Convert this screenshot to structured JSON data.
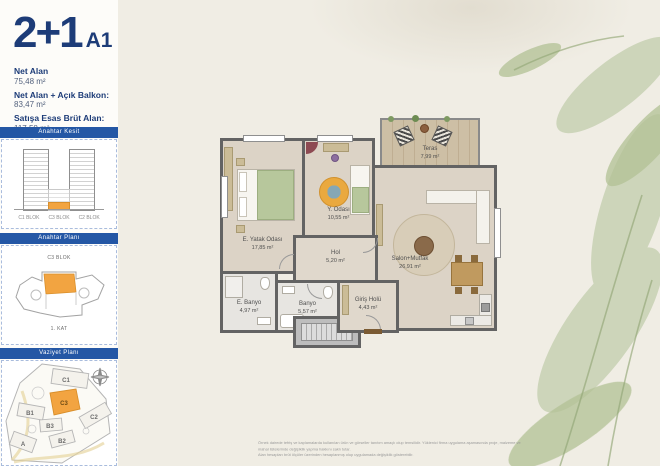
{
  "header": {
    "unit_type": "2+1",
    "variant": "A1"
  },
  "stats": {
    "items": [
      {
        "label": "Net Alan",
        "value": "75,48 m²"
      },
      {
        "label": "Net Alan + Açık Balkon:",
        "value": "83,47 m²"
      },
      {
        "label": "Satışa Esas Brüt Alan:",
        "value": "117,58 m²"
      }
    ]
  },
  "sidebar": {
    "key_section": {
      "title": "Anahtar Kesit",
      "block_labels": [
        "C1 BLOK",
        "C3 BLOK",
        "C2 BLOK"
      ]
    },
    "key_plan": {
      "title": "Anahtar Planı",
      "block_label": "C3 BLOK",
      "floor_label": "1. KAT"
    },
    "site_plan": {
      "title": "Vaziyet Planı",
      "block_labels": {
        "c1": "C1",
        "c3": "C3",
        "c2": "C2",
        "b1": "B1",
        "b3": "B3",
        "b2": "B2",
        "a": "A"
      }
    }
  },
  "floorplan": {
    "rooms": [
      {
        "name": "E. Yatak Odası",
        "area": "17,85 m²"
      },
      {
        "name": "Y. Odası",
        "area": "10,55 m²"
      },
      {
        "name": "Hol",
        "area": "5,20 m²"
      },
      {
        "name": "E. Banyo",
        "area": "4,97 m²"
      },
      {
        "name": "Banyo",
        "area": "5,57 m²"
      },
      {
        "name": "Giriş Holü",
        "area": "4,43 m²"
      },
      {
        "name": "Salon+Mutfak",
        "area": "26,91 m²"
      },
      {
        "name": "Teras",
        "area": "7,99 m²"
      }
    ]
  },
  "footer": {
    "disclaimer_line1": "Örnek dairede tefriş ve kaplamalarda kullanılan ürün ve görseller tanıtım amaçlı olup temsilidir. Yüklenici firma uygulama aşamasında proje, malzeme ve mahal listelerinde değişiklik yapma hakkını saklı tutar.",
    "disclaimer_line2": "Alan hesapları brüt ölçüler üzerinden hesaplanmış olup uygulamada değişiklik gösterebilir."
  },
  "colors": {
    "navy": "#1d3c78",
    "bar_blue": "#2457a5",
    "accent_orange": "#f2a441"
  }
}
